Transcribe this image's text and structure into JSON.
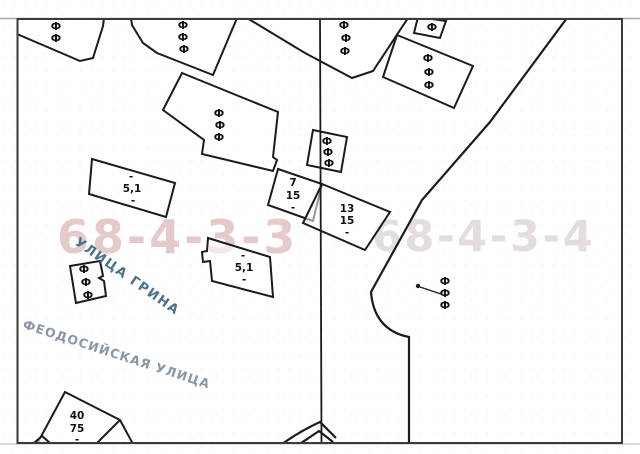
{
  "map": {
    "symbol_glyph": "Ф",
    "watermarks": [
      {
        "text": "68-4-3-3",
        "color": "#cf9fa0"
      },
      {
        "text": "68-4-3-4",
        "color": "#d7cbce"
      }
    ],
    "streets": [
      {
        "name": "УЛИЦА ГРИНА",
        "color": "#49718a"
      },
      {
        "name": "ФЕОДОСИЙСКАЯ УЛИЦА",
        "color": "#8b96a4"
      }
    ],
    "building_labels": {
      "b51_upper": {
        "l1": "-",
        "l2": "5,1",
        "l3": "-"
      },
      "b51_lower": {
        "l1": "-",
        "l2": "5,1",
        "l3": "-"
      },
      "b7_15": {
        "l1": "7",
        "l2": "15",
        "l3": "-"
      },
      "b13_15": {
        "l1": "13",
        "l2": "15",
        "l3": "-"
      },
      "b40_75": {
        "l1": "40",
        "l2": "75",
        "l3": "-"
      }
    },
    "line_color": "#1b1b1b"
  }
}
